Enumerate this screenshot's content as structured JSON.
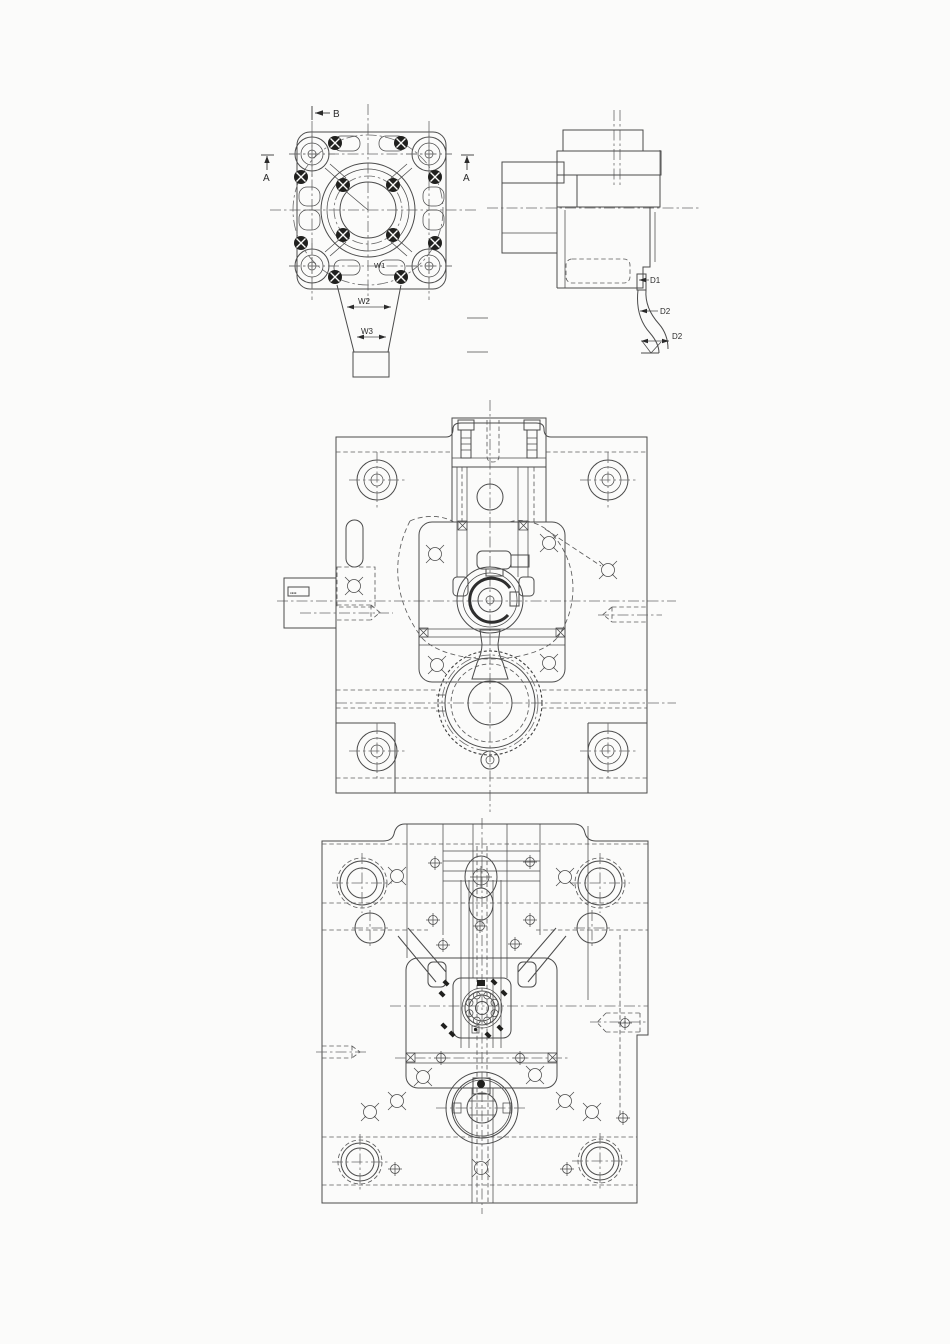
{
  "page": {
    "background": "#fbfbfa",
    "line_color": "#4b4b4b",
    "fill_color": "#20201e"
  },
  "top_drawing": {
    "front_view": {
      "view_arrow_label": "B",
      "section_label_left": "A",
      "section_label_right": "A",
      "dim_w1": "W1",
      "dim_w2": "W2",
      "dim_w3": "W3"
    },
    "side_view": {
      "dim_d1": "D1",
      "dim_d2_upper": "D2",
      "dim_d2_lower": "D2"
    }
  },
  "middle_drawing": {
    "side_tag": "▪▪▪▪"
  }
}
